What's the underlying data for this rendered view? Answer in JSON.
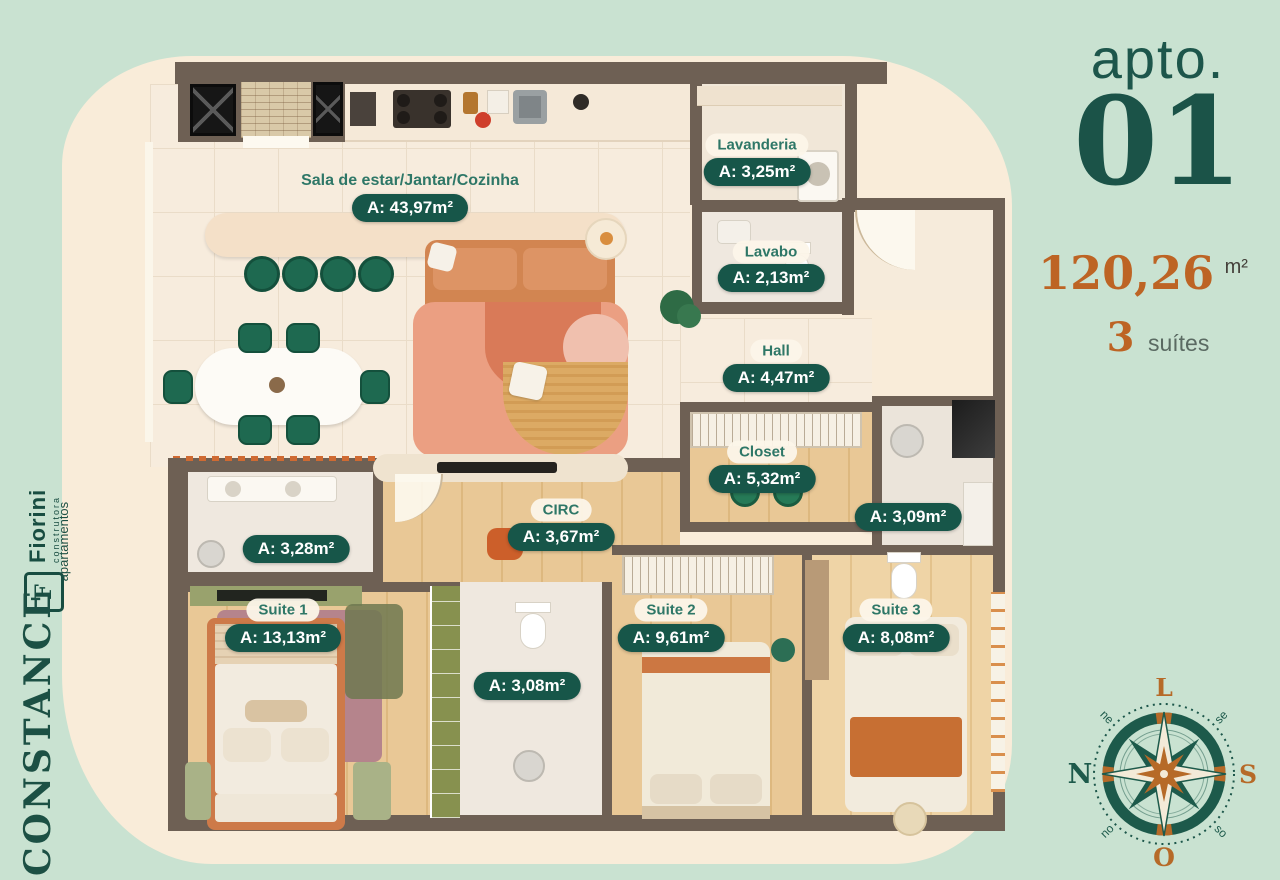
{
  "colors": {
    "mint_bg": "#c9e2d1",
    "cream_panel": "#f9ecd9",
    "brand_green": "#1b5348",
    "pill_green": "#175649",
    "accent_orange": "#bd6424",
    "wall": "#6e6054"
  },
  "branding": {
    "developer": {
      "logo_letter": "F",
      "name": "Fiorini",
      "tagline": "construtora"
    },
    "project": {
      "name": "CONSTANCE",
      "tagline": "apartamentos"
    }
  },
  "apartment": {
    "label": "apto.",
    "number": "01",
    "total_area": "120,26",
    "total_area_unit": "m²",
    "suites_count": "3",
    "suites_label": "suítes"
  },
  "floor_plan": {
    "labels": [
      {
        "name": "Sala de estar/Jantar/Cozinha",
        "area": "A: 43,97m²",
        "cx": 265,
        "name_cy": 119,
        "area_cy": 146,
        "bare_name": true
      },
      {
        "name": "Lavanderia",
        "area": "A: 3,25m²",
        "cx": 612,
        "name_cy": 83,
        "area_cy": 110
      },
      {
        "name": "Lavabo",
        "area": "A: 2,13m²",
        "cx": 626,
        "name_cy": 190,
        "area_cy": 216
      },
      {
        "name": "Hall",
        "area": "A: 4,47m²",
        "cx": 631,
        "name_cy": 289,
        "area_cy": 316
      },
      {
        "name": "Closet",
        "area": "A: 5,32m²",
        "cx": 617,
        "name_cy": 390,
        "area_cy": 417
      },
      {
        "name": null,
        "area": "A: 3,09m²",
        "cx": 763,
        "area_cy": 455
      },
      {
        "name": null,
        "area": "A: 3,28m²",
        "cx": 151,
        "area_cy": 487
      },
      {
        "name": "CIRC",
        "area": "A: 3,67m²",
        "cx": 416,
        "name_cy": 448,
        "area_cy": 475
      },
      {
        "name": "Suite 1",
        "area": "A: 13,13m²",
        "cx": 138,
        "name_cy": 548,
        "area_cy": 576
      },
      {
        "name": "Suite 2",
        "area": "A: 9,61m²",
        "cx": 526,
        "name_cy": 548,
        "area_cy": 576
      },
      {
        "name": "Suite 3",
        "area": "A: 8,08m²",
        "cx": 751,
        "name_cy": 548,
        "area_cy": 576
      },
      {
        "name": null,
        "area": "A: 3,08m²",
        "cx": 382,
        "area_cy": 624
      }
    ]
  },
  "compass": {
    "cardinals": {
      "top": "L",
      "right": "S",
      "bottom": "O",
      "left": "N"
    },
    "intercardinals": {
      "top_left": "ne",
      "top_right": "se",
      "bottom_right": "so",
      "bottom_left": "no"
    }
  }
}
